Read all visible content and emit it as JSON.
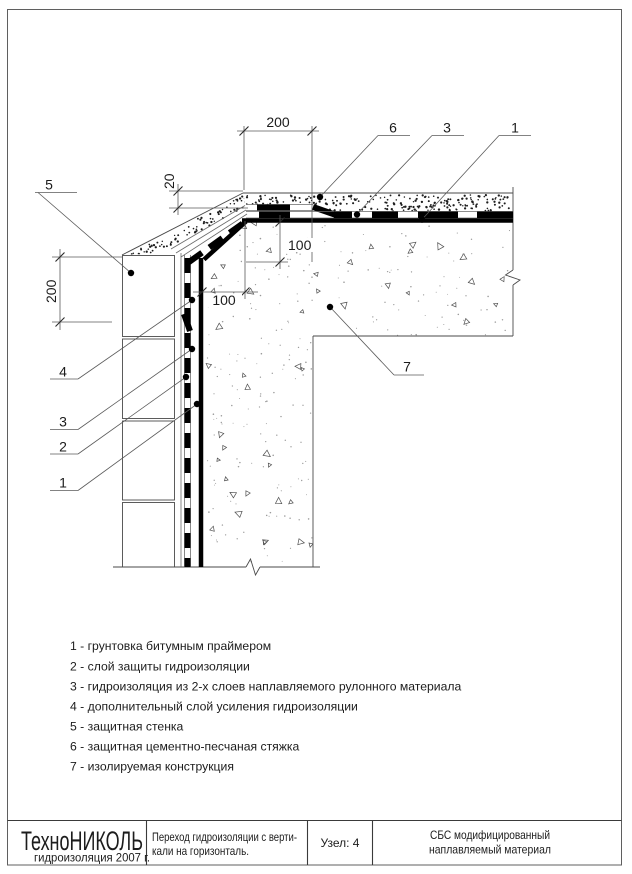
{
  "colors": {
    "background": "#ffffff",
    "line": "#000000"
  },
  "drawing_labels": {
    "dim_top_200": "200",
    "dim_thickness_20": "20",
    "dim_wall_200": "200",
    "dim_chamfer_v_100": "100",
    "dim_chamfer_h_100": "100",
    "callout_protective_wall": "5",
    "callout_screed": "6",
    "callout_membrane_top": "3",
    "callout_primer_top": "1",
    "callout_reinforcing_layer": "4",
    "callout_membrane_left": "3",
    "callout_protection_layer": "2",
    "callout_primer_left": "1",
    "callout_structure": "7"
  },
  "legend": {
    "items": [
      "1 - грунтовка битумным праймером",
      "2 -  слой защиты гидроизоляции",
      "3 - гидроизоляция из 2-х слоев наплавляемого рулонного материала",
      "4 - дополнительный слой усиления гидроизоляции",
      "5 - защитная стенка",
      "6 - защитная цементно-песчаная стяжка",
      "7 - изолируемая конструкция"
    ]
  },
  "title_block": {
    "brand": "ТехноНИКОЛЬ",
    "brand_subtitle": "гидроизоляция 2007 г.",
    "description_line1": "Переход гидроизоляции с верти-",
    "description_line2": "кали на горизонталь.",
    "node_label": "Узел: 4",
    "material_line1": "СБС модифицированный",
    "material_line2": "наплавляемый материал"
  }
}
